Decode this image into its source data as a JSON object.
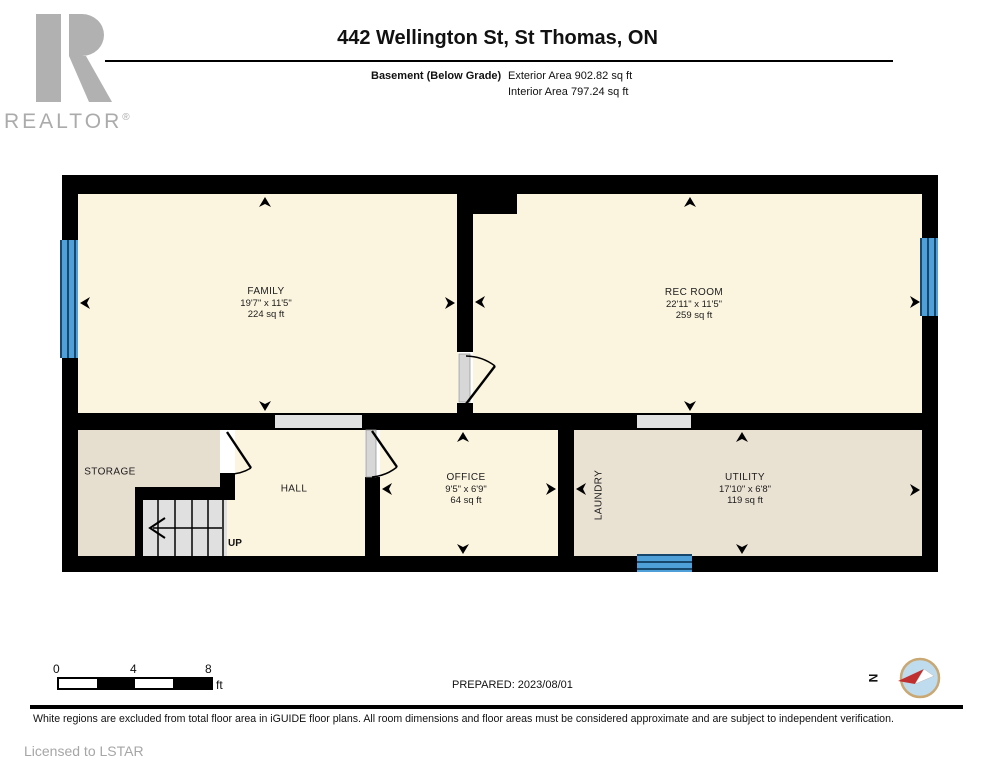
{
  "header": {
    "realtor": "REALTOR",
    "reg": "®",
    "title": "442 Wellington St, St Thomas, ON",
    "floor_label": "Basement (Below Grade)",
    "exterior_area": "Exterior Area 902.82 sq ft",
    "interior_area": "Interior Area 797.24 sq ft"
  },
  "rooms": {
    "family": {
      "name": "FAMILY",
      "dims": "19'7\" x 11'5\"",
      "area": "224 sq ft"
    },
    "rec_room": {
      "name": "REC ROOM",
      "dims": "22'11\" x 11'5\"",
      "area": "259 sq ft"
    },
    "office": {
      "name": "OFFICE",
      "dims": "9'5\" x 6'9\"",
      "area": "64 sq ft"
    },
    "utility": {
      "name": "UTILITY",
      "dims": "17'10\" x 6'8\"",
      "area": "119 sq ft"
    },
    "storage": {
      "name": "STORAGE"
    },
    "hall": {
      "name": "HALL"
    },
    "laundry": {
      "name": "LAUNDRY"
    },
    "stairs": {
      "label": "UP"
    }
  },
  "scale": {
    "start": "0",
    "mid": "4",
    "end": "8",
    "unit": "ft"
  },
  "prepared": "PREPARED: 2023/08/01",
  "compass": {
    "north": "N"
  },
  "footer": {
    "disclaimer": "White regions are excluded from total floor area in iGUIDE floor plans. All room dimensions and floor areas must be considered approximate and are subject to independent verification.",
    "license": "Licensed to LSTAR"
  },
  "colors": {
    "wall": "#000000",
    "main_floor": "#FBF5DF",
    "utility_floor": "#E9E1D2",
    "storage_floor": "#E6DECF",
    "stairs_floor": "#E0E0E0",
    "window_blue": "#4FA0D8",
    "window_line": "#17476B",
    "opening_gray": "#E2E2E2",
    "compass_ring": "#C9A873",
    "compass_fill": "#BFDCEF",
    "needle_red": "#C03030",
    "logo_gray": "#B1B1B1"
  }
}
